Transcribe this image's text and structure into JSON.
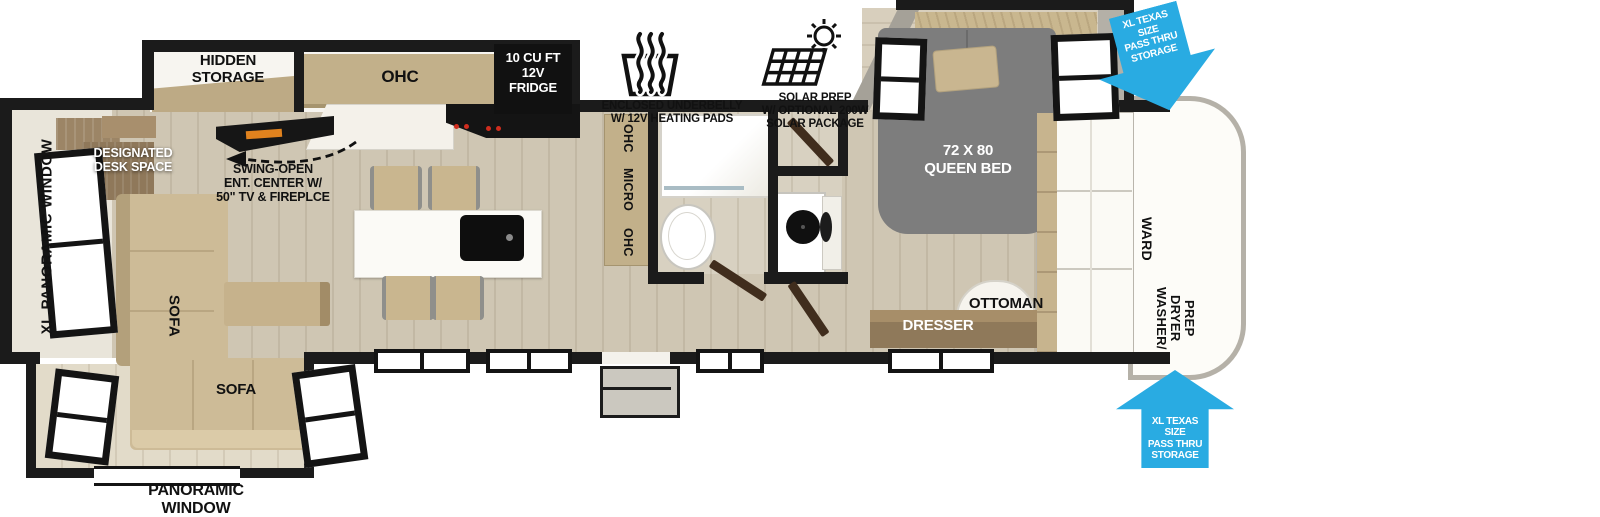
{
  "colors": {
    "wall_black": "#1b1b1b",
    "arrow_blue": "#29abe2",
    "floor_wood": "#cfc6b3",
    "furniture_tan": "#cdbb97",
    "cabinet_tan": "#c2b08a",
    "bed_gray": "#7d7d7d",
    "desk_brown": "#9c8566",
    "dresser_brown": "#8f795a",
    "fireplace_orange": "#e0821e",
    "burner_red": "#cf2d1e"
  },
  "callouts": {
    "underbelly": {
      "icon": "heating-pads-icon",
      "lines": [
        "ENCLOSED UNDERBELLY",
        "W/ 12V HEATING PADS"
      ]
    },
    "solar": {
      "icon": "solar-panel-icon",
      "lines": [
        "SOLAR PREP",
        "W/ OPTIONAL 200W",
        "SOLAR PACKAGE"
      ]
    },
    "pass_thru_top": {
      "lines": [
        "XL TEXAS SIZE",
        "PASS THRU",
        "STORAGE"
      ]
    },
    "pass_thru_bottom": {
      "lines": [
        "XL TEXAS SIZE",
        "PASS THRU",
        "STORAGE"
      ]
    }
  },
  "labels": {
    "hidden_storage": "HIDDEN STORAGE",
    "ohc": "OHC",
    "fridge_lines": [
      "10 CU FT",
      "12V",
      "FRIDGE"
    ],
    "micro_words": [
      "OHC",
      "MICRO",
      "OHC"
    ],
    "desk_lines": [
      "DESIGNATED",
      "DESK SPACE"
    ],
    "ent_center_lines": [
      "SWING-OPEN",
      "ENT. CENTER W/",
      "50\" TV & FIREPLCE"
    ],
    "xl_panoramic_window": "XL PANORAMIC WINDOW",
    "sofa_vertical": "SOFA",
    "sofa_horizontal": "SOFA",
    "panoramic_window_lines": [
      "PANORAMIC",
      "WINDOW"
    ],
    "queen_bed_lines": [
      "72 X 80",
      "QUEEN BED"
    ],
    "ottoman": "OTTOMAN",
    "dresser": "DRESSER",
    "wardrobe": "WARD",
    "washer_dryer_lines": [
      "WASHER/",
      "DRYER",
      "PREP"
    ]
  }
}
